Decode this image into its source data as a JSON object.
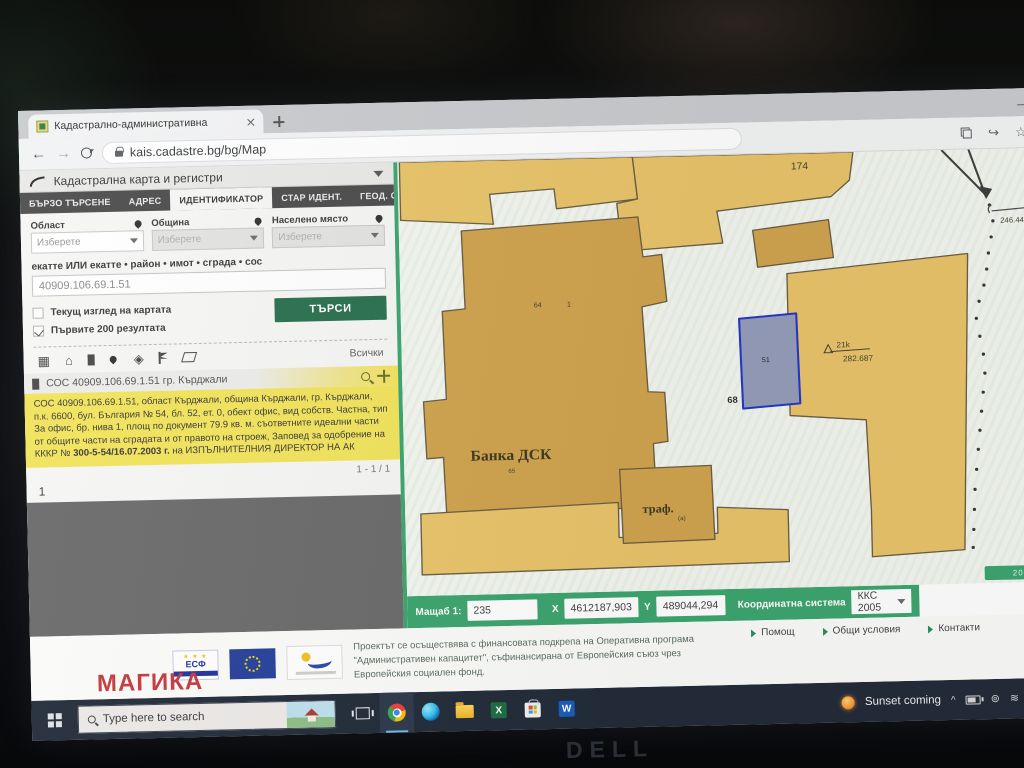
{
  "colors": {
    "accent_green": "#2a7150",
    "bar_green": "#3da56f",
    "highlight_yellow": "#f2e45c",
    "parcel_yellow": "#e9c46a",
    "building_tan": "#d0a44f",
    "selected_parcel_blue": "#2438c8",
    "taskbar_dark": "#232c3a",
    "watermark_red": "#c23b3f"
  },
  "browser": {
    "tab_title": "Кадастрално-административна",
    "url": "kais.cadastre.bg/bg/Map"
  },
  "site": {
    "header": {
      "title": "Кадастрална карта и регистри"
    },
    "tabs": [
      {
        "label": "БЪРЗО ТЪРСЕНЕ",
        "active": false
      },
      {
        "label": "АДРЕС",
        "active": false
      },
      {
        "label": "ИДЕНТИФИКАТОР",
        "active": true
      },
      {
        "label": "СТАР ИДЕНТ.",
        "active": false
      },
      {
        "label": "ГЕОД. ОСНОВА",
        "active": false
      }
    ],
    "search": {
      "fields": [
        {
          "label": "Област",
          "placeholder": "Изберете"
        },
        {
          "label": "Община",
          "placeholder": "Изберете"
        },
        {
          "label": "Населено място",
          "placeholder": "Изберете"
        }
      ],
      "ekatte_label": "екатте ИЛИ екатте • район • имот • сграда • сос",
      "ekatte_value": "40909.106.69.1.51",
      "checkbox_current_view": "Текущ изглед на картата",
      "checkbox_first_200": "Първите 200 резултата",
      "search_button": "ТЪРСИ",
      "filter_all": "Всички"
    },
    "results": {
      "title": "СОС 40909.106.69.1.51 гр. Кърджали",
      "text_p1": "СОС 40909.106.69.1.51, област Кърджали, община Кърджали, гр. Кърджали, п.к. 6600, бул. България № 54, бл. 52, ет. 0, обект офис, вид собств. Частна, тип За офис, бр. нива 1, площ по документ 79.9 кв. м. съответните идеални части от общите части на сградата и от правото на строеж, Заповед за одобрение на КККР № ",
      "text_bold": "300-5-54/16.07.2003 г.",
      "text_p2": " на ИЗПЪЛНИТЕЛНИЯ ДИРЕКТОР НА АК",
      "pagination": "1 - 1 / 1",
      "page_number": "1"
    },
    "map": {
      "labels": {
        "parcel_174": "174",
        "label_64": "64",
        "label_1": "1",
        "bank": "Банка ДСК",
        "bank_sub": "65",
        "traf": "траф.",
        "traf_sub": "(а)",
        "label_68": "68",
        "label_51": "51",
        "label_21k": "21k",
        "label_282": "282.687",
        "label_246": "246.448",
        "scale_chip": "20 m"
      }
    },
    "statusbar": {
      "scale_label": "Мащаб 1:",
      "scale_value": "235",
      "x_label": "X",
      "x_value": "4612187,903",
      "y_label": "Y",
      "y_value": "489044,294",
      "coord_label": "Координатна система",
      "coord_value": "ККС 2005"
    },
    "footer": {
      "esf": "ЕСФ",
      "esf_stars": "★ ★ ★",
      "line1": "Проектът се осъществява с финансовата подкрепа на Оперативна програма",
      "line2": "\"Административен капацитет\", съфинансирана от Европейския съюз чрез",
      "line3": "Европейския социален фонд.",
      "links": [
        {
          "label": "Помощ"
        },
        {
          "label": "Общи условия"
        },
        {
          "label": "Контакти"
        }
      ]
    }
  },
  "watermark": "МАГИКА",
  "taskbar": {
    "search_placeholder": "Type here to search",
    "tray_label": "Sunset coming",
    "tray_chevron": "^",
    "excel_letter": "X",
    "word_letter": "W",
    "lang1": "ENG",
    "lang2": "US"
  },
  "laptop_brand": "DELL"
}
